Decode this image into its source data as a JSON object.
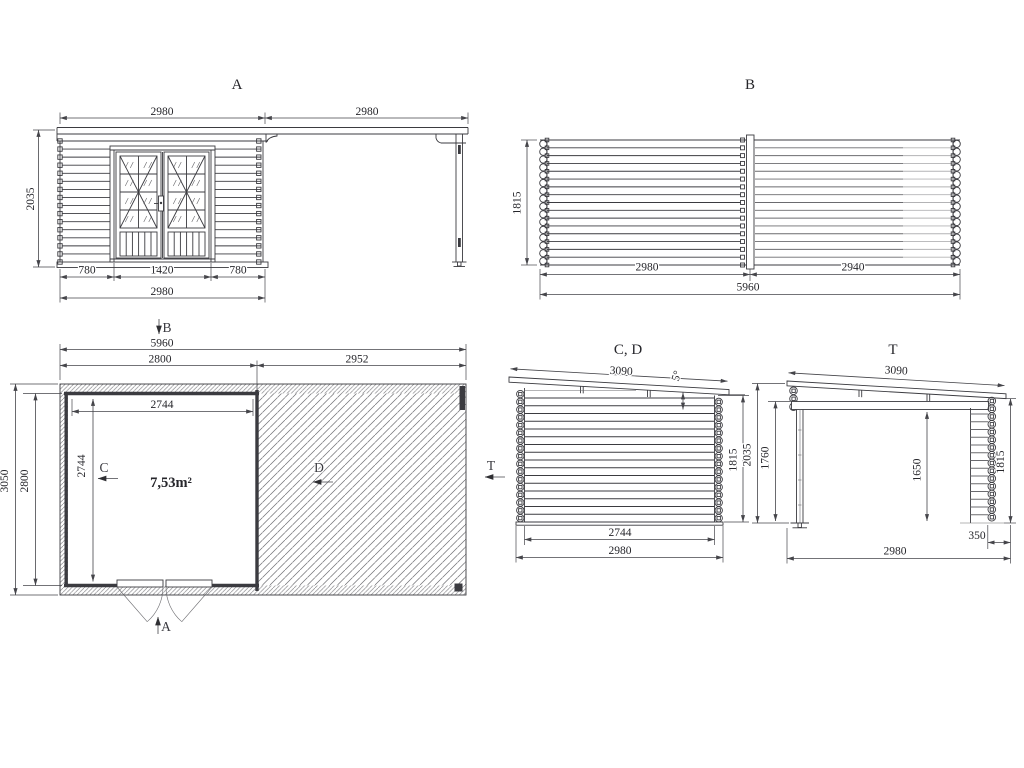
{
  "style": {
    "background": "#ffffff",
    "ink": "#3b3b40",
    "dim_ink": "#45454a",
    "mid_line": "#6b6b6f",
    "light_line": "#b3b3b5",
    "hatch": "#77777b"
  },
  "views": {
    "front": {
      "title": "A",
      "dims": {
        "top_left": "2980",
        "top_right": "2980",
        "height_left": "2035",
        "bottom_left": "780",
        "bottom_center": "1420",
        "bottom_right": "780",
        "bottom_total": "2980"
      }
    },
    "rear": {
      "title": "B",
      "dims": {
        "height_left": "1815",
        "bottom_left": "2980",
        "bottom_right": "2940",
        "bottom_total": "5960"
      }
    },
    "plan": {
      "area_label": "7,53m²",
      "section_arrows": {
        "top": "B",
        "bottom": "A",
        "left_inner": "C",
        "terrace": "D",
        "right": "T"
      },
      "dims": {
        "top_total": "5960",
        "top_left": "2800",
        "top_right": "2952",
        "inner_width": "2744",
        "outer_depth": "3050",
        "room_depth": "2800",
        "inner_depth": "2744"
      }
    },
    "side_cd": {
      "title": "C, D",
      "dims": {
        "roof_length": "3090",
        "roof_angle": "5°",
        "inner_width": "2744",
        "bottom_total": "2980",
        "wall_height": "1815"
      }
    },
    "side_t": {
      "title": "T",
      "dims": {
        "roof_length": "3090",
        "height_outer": "2035",
        "post_height": "1760",
        "clear_height": "1650",
        "wall_height": "1815",
        "wall_stub": "350",
        "bottom_total": "2980"
      }
    }
  }
}
